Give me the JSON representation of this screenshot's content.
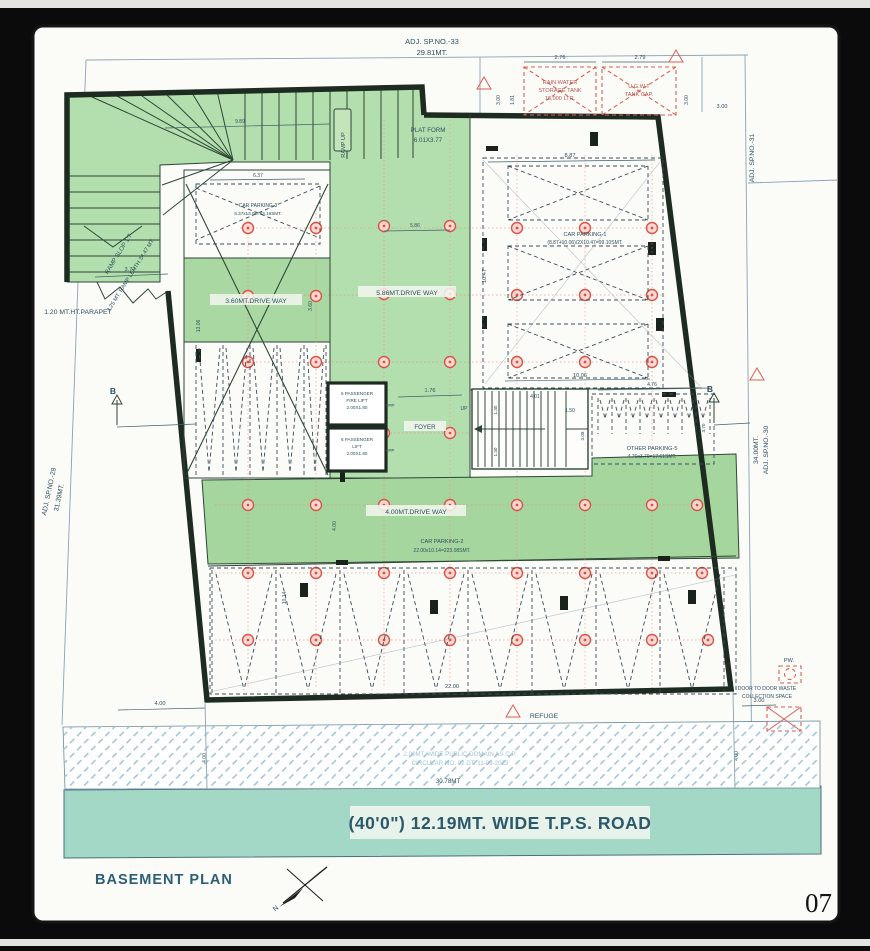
{
  "adjacent": {
    "top_1": "ADJ. SP.NO.-33",
    "top_2": "29.81MT.",
    "right_upper": "ADJ. SP.NO.-31",
    "right_lower_1": "34.00MT.",
    "right_lower_2": "ADJ. SP.NO.-30",
    "left_1": "ADJ. SP.NO.-28",
    "left_2": "31.39MT."
  },
  "ramp": {
    "slope": "RAMP SLOP 1:7",
    "length_note": "3.25 MT. RAMP LENTH 34.47 MT.",
    "up_label": "RAMP UP",
    "run_dim": "9.89",
    "parapet_label": "1.20 MT.HT.PARAPET",
    "parapet_dim": "3.77"
  },
  "platform": {
    "line1": "PLAT FORM",
    "line2": "6.01X3.77"
  },
  "tanks": {
    "rain_1": "RAIN WATER",
    "rain_2": "STORAGE TANK",
    "rain_3": "18,000 LTR.",
    "ug_1": "U.G.W.T",
    "ug_2": "TANK CAP.",
    "dim_w1": "2.76",
    "dim_w2": "2.79",
    "dim_h": "1.81",
    "dim_s1": "3.00",
    "dim_s2": "3.00",
    "dim_s3": "3.00"
  },
  "parking": {
    "p1_name": "CAR PARKING-1",
    "p1_calc": "(8.87+10.06)/2X10.47=99.10SMT.",
    "p1_dim_top": "8.87",
    "p1_dim_side": "10.47",
    "p1_dim_bottom": "10.06",
    "p2_name": "CAR PARKING-2",
    "p2_calc": "22.00x10.14=223.08SMT.",
    "p2_dim_w": "22.00",
    "p2_dim_h": "10.14",
    "p3_name": "CAR PARKING-3",
    "p3_calc": "6.37x13.06=83.19SMT.",
    "p3_dim_top": "6.37",
    "p3_dim_side": "13.06",
    "p5_name": "OTHER PARKING-5",
    "p5_calc": "4.76x3.70=17.61SMT.",
    "p5_dim_top": "4.76",
    "p5_dim_side": "3.70"
  },
  "driveways": {
    "d360": "3.60MT.DRIVE WAY",
    "d360_dim": "3.60",
    "d586": "5.86MT.DRIVE WAY",
    "d586_dim": "5.86",
    "d400": "4.00MT.DRIVE WAY",
    "d400_dim": "4.00"
  },
  "core": {
    "fire_lift_1": "6 PASSENGER",
    "fire_lift_2": "FIRE LIFT",
    "fire_lift_3": "2.00X1.80",
    "fire_lift_tag": "FPP",
    "lift_1": "6 PASSENGER",
    "lift_2": "LIFT",
    "lift_3": "2.00X1.80",
    "lift_tag": "FPP",
    "foyer": "FOYER",
    "dim_176": "1.76",
    "stair_up": "UP",
    "dim_401": "4.01",
    "dim_150": "1.50",
    "dim_130a": "1.30",
    "dim_130b": "1.30",
    "dim_308": "3.08",
    "dim_1006": "10.06"
  },
  "section": {
    "b_left": "B",
    "b_right": "B"
  },
  "site": {
    "refuge": "REFUGE",
    "dim_400_corner": "4.00",
    "dim_400_left": "4.00",
    "dim_400_right": "4.00",
    "public_domain_1": "2.00MT. WIDE PUBLIC DOMAIN AS C.P.",
    "public_domain_2": "CIRCULAR NO. 02 DT. 11-09-2023",
    "pw": "PW.",
    "waste_1": "DOOR TO DOOR WASTE",
    "waste_2": "COLLECTION SPACE",
    "dim_300": "3.00"
  },
  "road": {
    "dim": "30.78MT",
    "label": "(40'0\") 12.19MT. WIDE T.P.S. ROAD"
  },
  "titles": {
    "plan": "BASEMENT PLAN",
    "north": "N",
    "page_no": "07"
  }
}
